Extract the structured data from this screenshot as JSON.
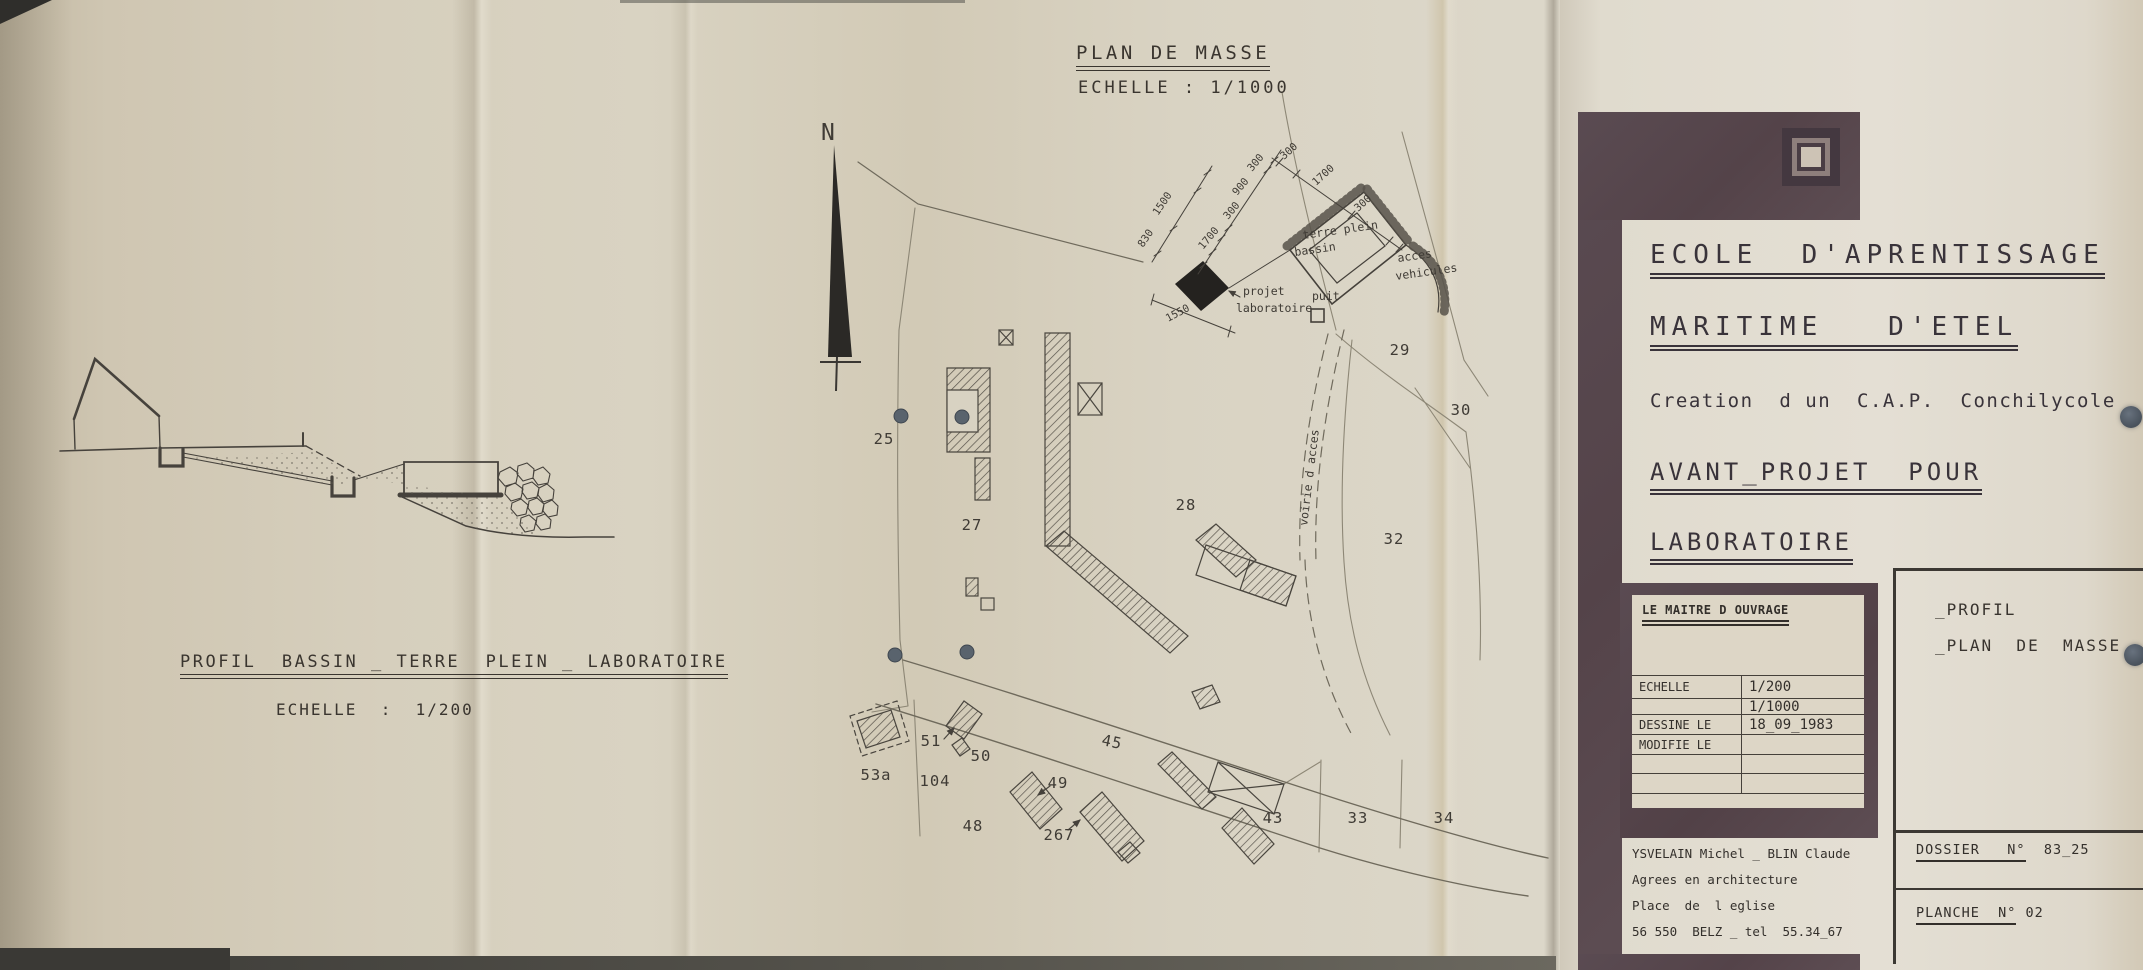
{
  "plan": {
    "title": "PLAN DE MASSE",
    "scale": "ECHELLE : 1/1000",
    "north_label": "N",
    "labels": {
      "terre_plein": "terre plein",
      "bassin": "bassin",
      "acces": "acces",
      "vehicules": "vehicules",
      "projet": "projet",
      "laboratoire": "laboratoire",
      "puit": "puit",
      "voie": "voirie d acces"
    },
    "dimensions": [
      "300",
      "900",
      "300",
      "1700",
      "300",
      "1700",
      "300",
      "1500",
      "830",
      "1550"
    ],
    "parcels": [
      {
        "label": "25"
      },
      {
        "label": "27"
      },
      {
        "label": "28"
      },
      {
        "label": "29"
      },
      {
        "label": "30"
      },
      {
        "label": "32"
      },
      {
        "label": "33"
      },
      {
        "label": "34"
      },
      {
        "label": "43"
      },
      {
        "label": "45"
      },
      {
        "label": "48"
      },
      {
        "label": "49"
      },
      {
        "label": "50"
      },
      {
        "label": "51"
      },
      {
        "label": "53a"
      },
      {
        "label": "104"
      },
      {
        "label": "267"
      }
    ]
  },
  "profile": {
    "title": "PROFIL  BASSIN _ TERRE  PLEIN _ LABORATOIRE",
    "scale": "ECHELLE  :  1/200"
  },
  "title_block": {
    "line1": "ECOLE  D'APRENTISSAGE",
    "line2": "MARITIME   D'ETEL",
    "line3": "Creation  d un  C.A.P.  Conchilycole",
    "line4": "AVANT_PROJET  POUR",
    "line5": "LABORATOIRE"
  },
  "owner_table": {
    "header": "LE MAITRE D OUVRAGE",
    "rows": [
      {
        "label": "ECHELLE",
        "value": "1/200"
      },
      {
        "label": "",
        "value": "1/1000"
      },
      {
        "label": "DESSINE LE",
        "value": "18_09_1983"
      },
      {
        "label": "MODIFIE LE",
        "value": ""
      },
      {
        "label": "",
        "value": ""
      },
      {
        "label": "",
        "value": ""
      }
    ]
  },
  "sheet_box": {
    "line1": "_PROFIL",
    "line2": "_PLAN  DE  MASSE"
  },
  "dossier": {
    "label": "DOSSIER   N°",
    "value": "83_25"
  },
  "planche": {
    "label": "PLANCHE  N°",
    "value": "02"
  },
  "architects": {
    "line1": "YSVELAIN Michel _ BLIN Claude",
    "line2": "Agrees en architecture",
    "line3": "Place  de  l eglise",
    "line4": "56 550  BELZ _ tel  55.34_67"
  },
  "colors": {
    "paper": "#d6cfbd",
    "panel_frame": "#57484f",
    "ink": "#3c3833",
    "hole": "#59636d"
  }
}
